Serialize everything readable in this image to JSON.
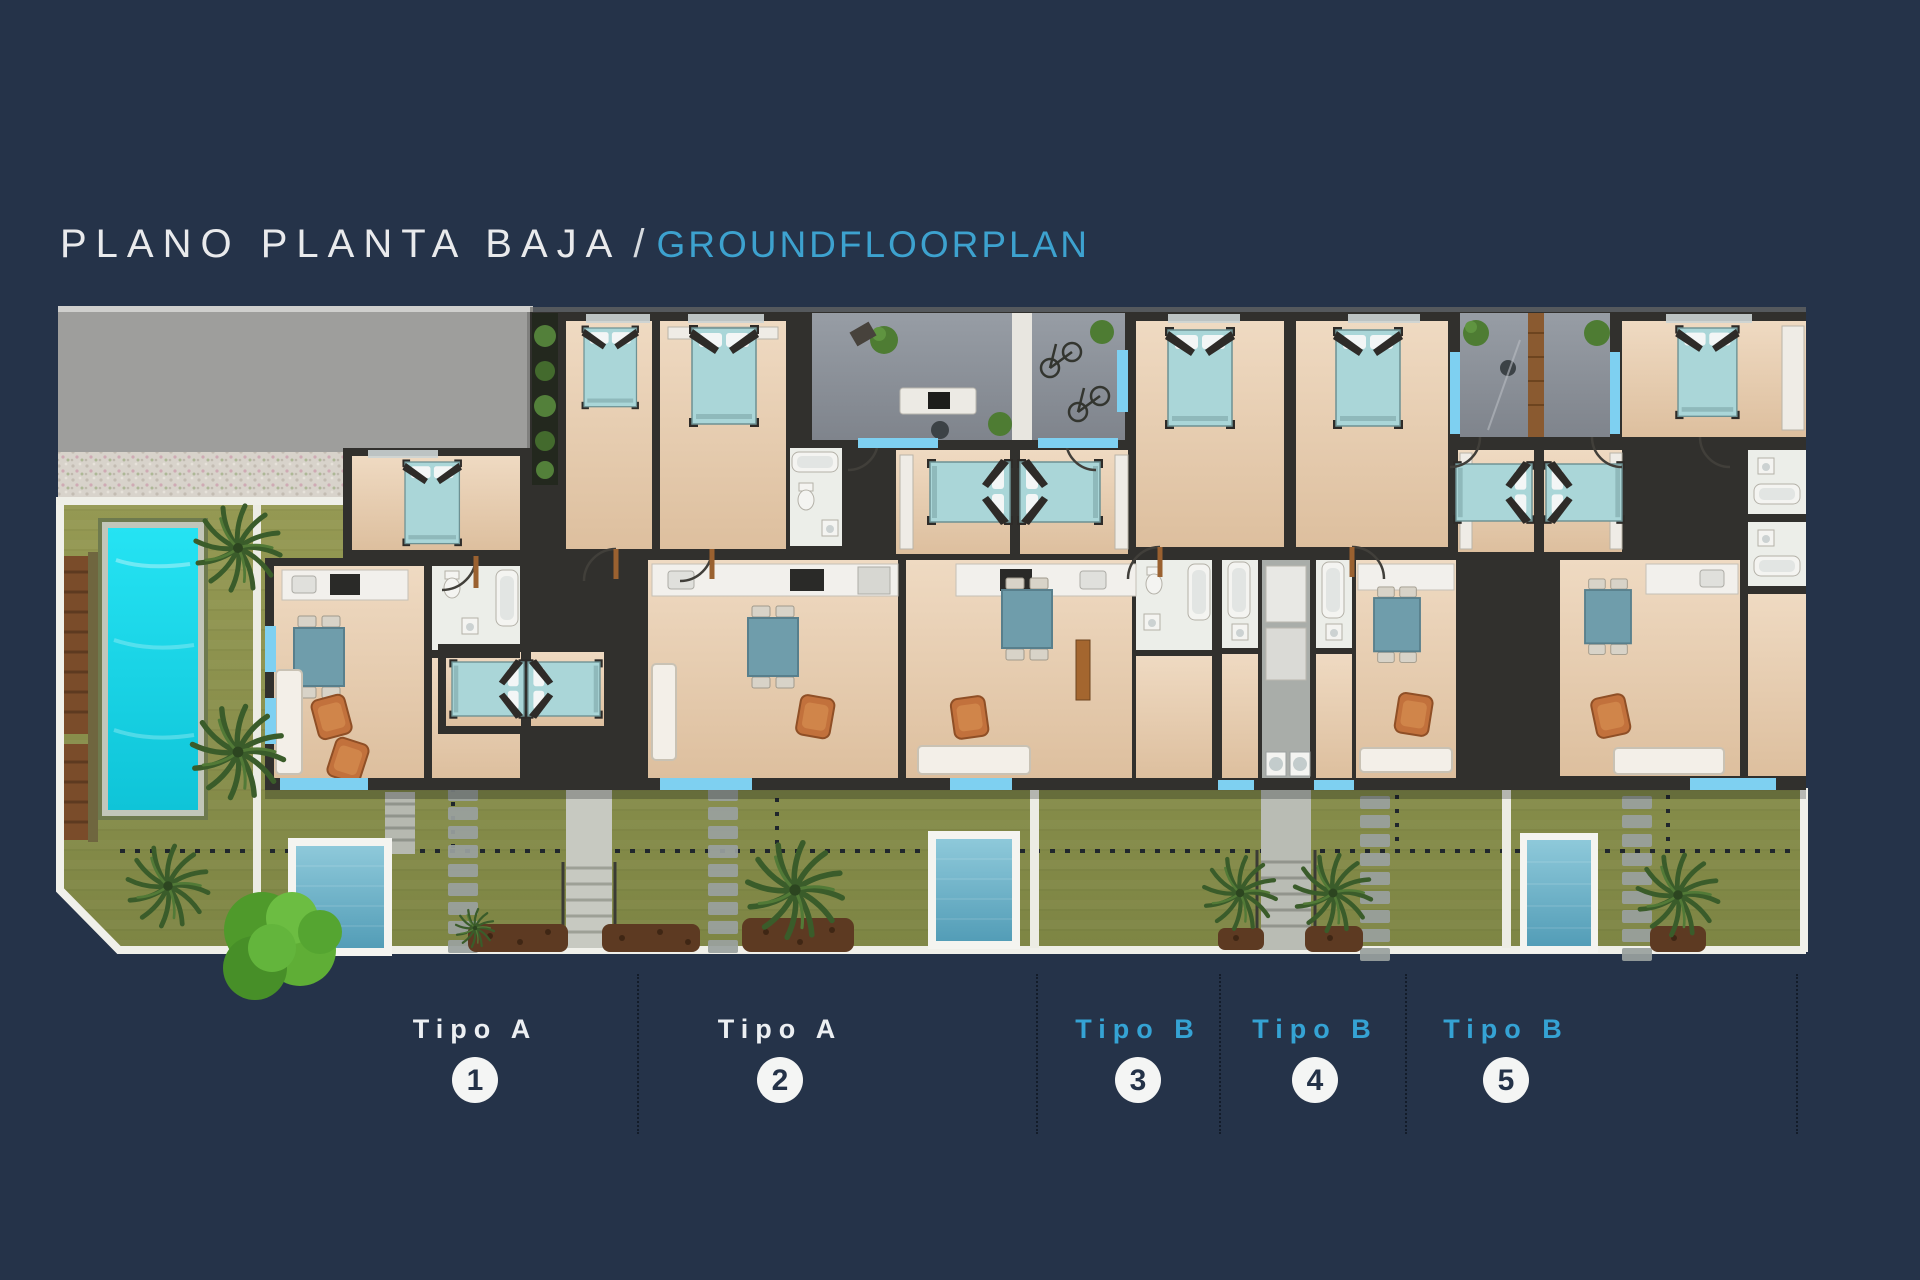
{
  "title": {
    "primary": "PLANO PLANTA BAJA",
    "separator": "/",
    "secondary": "GROUNDFLOORPLAN"
  },
  "legend_units": [
    {
      "type_label": "Tipo A",
      "number": "1",
      "variant": "a"
    },
    {
      "type_label": "Tipo A",
      "number": "2",
      "variant": "a"
    },
    {
      "type_label": "Tipo B",
      "number": "3",
      "variant": "b"
    },
    {
      "type_label": "Tipo B",
      "number": "4",
      "variant": "b"
    },
    {
      "type_label": "Tipo B",
      "number": "5",
      "variant": "b"
    }
  ],
  "colors": {
    "background_navy": "#253349",
    "title_white": "#e9eaec",
    "accent_cyan": "#3da2cf",
    "legend_cyan": "#35a3d4",
    "circle_white": "#f4f5f4",
    "lap_pool_cyan": "#1bdcec",
    "plunge_pool_blue": "#6fb7cc",
    "lawn_olive": "#8f9350",
    "road_gray": "#9e9e9c",
    "patio_gray": "#8f949c",
    "floor_beige": "#e9d3ba",
    "wall_dark": "#31302d",
    "bed_teal": "#aad6d8",
    "window_sill_blue": "#7ed0f1"
  },
  "plan_features": [
    "access-road",
    "gravel-path",
    "communal-garden",
    "lap-pool",
    "sun-loungers",
    "garden-tree",
    "palm-trees",
    "plunge-pool-unit-1",
    "plunge-pool-unit-3",
    "plunge-pool-unit-5",
    "front-lawns",
    "stepping-stones",
    "central-stairs",
    "shared-patio",
    "bicycle-patio",
    "entrance-courtyard",
    "bedrooms",
    "bathrooms",
    "kitchens",
    "living-dining-rooms",
    "laundry-corridor",
    "boundary-dotted-lines"
  ]
}
